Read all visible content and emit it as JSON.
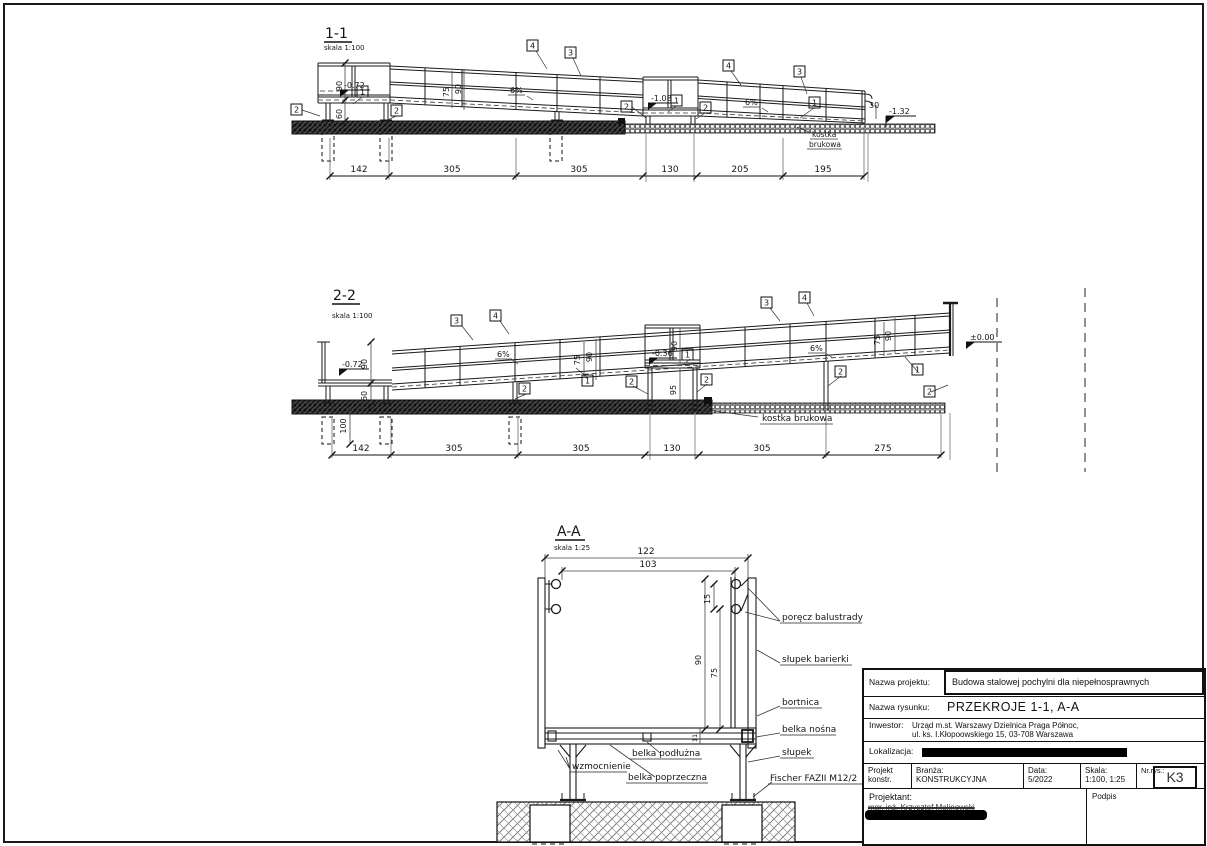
{
  "markers": {
    "m1": "1",
    "m2": "2",
    "m3": "3",
    "m4": "4"
  },
  "sections": {
    "s1": {
      "title": "1-1",
      "scale": "skala 1:100",
      "dims": [
        "142",
        "305",
        "305",
        "130",
        "205",
        "195"
      ],
      "vdims": {
        "h90": "90",
        "h60": "60",
        "h75": "75",
        "h30": "30"
      },
      "elev": {
        "left": "-0.72",
        "mid": "-1.08",
        "right": "-1.32"
      },
      "slope": "6%",
      "note1": "kostka",
      "note2": "brukowa"
    },
    "s2": {
      "title": "2-2",
      "scale": "skala 1:100",
      "dims": [
        "142",
        "305",
        "305",
        "130",
        "305",
        "275"
      ],
      "vdims": {
        "h90": "90",
        "h60": "60",
        "h100": "100",
        "h75": "75",
        "h95": "95"
      },
      "elev": {
        "left": "-0.72",
        "mid": "-0.36",
        "right": "±0.00"
      },
      "slope": "6%",
      "note": "kostka brukowa"
    },
    "s3": {
      "title": "A-A",
      "scale": "skala 1:25",
      "dims": {
        "w122": "122",
        "w103": "103",
        "h15": "15",
        "h90": "90",
        "h75": "75",
        "h11": "11"
      },
      "labels": {
        "handrail": "poręcz balustrady",
        "barrier_post": "słupek barierki",
        "bortnica": "bortnica",
        "load_beam": "belka nośna",
        "post": "słupek",
        "anchor": "Fischer FAZII M12/2",
        "brace": "wzmocnienie",
        "longitudinal_beam": "belka podłużna",
        "cross_beam": "belka poprzeczna"
      }
    }
  },
  "titleblock": {
    "project_label": "Nazwa projektu:",
    "project": "Budowa stalowej pochylni dla niepełnosprawnych",
    "drawing_label": "Nazwa rysunku:",
    "drawing": "PRZEKROJE 1-1, A-A",
    "investor_label": "Inwestor:",
    "investor_line1": "Urząd m.st. Warszawy Dzielnica Praga Północ,",
    "investor_line2": "ul. ks. I.Kłopoowskiego 15, 03-708 Warszawa",
    "location_label": "Lokalizacja:",
    "design_label": "Projekt konstr.",
    "branch_label": "Branża:",
    "branch": "KONSTRUKCYJNA",
    "date_label": "Data:",
    "date": "5/2022",
    "scale_label": "Skala:",
    "scale": "1:100, 1:25",
    "number_label": "Nr.rys.:",
    "number": "K3",
    "designer_label": "Projektant:",
    "designer": "mgr. inż. Krzysztof Malinowski",
    "signature_label": "Podpis"
  }
}
